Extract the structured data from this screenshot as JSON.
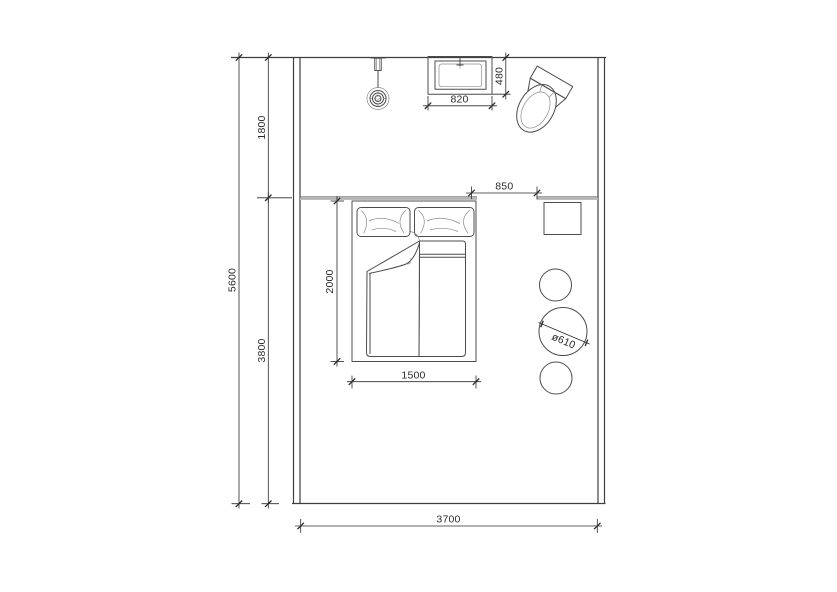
{
  "drawing": {
    "type": "bedroom floor plan",
    "dimensions_mm": {
      "total_depth": "5600",
      "entry_zone_depth": "1800",
      "bedroom_zone_depth": "3800",
      "room_width": "3700",
      "basin_width": "820",
      "basin_depth": "480",
      "opening_width": "850",
      "bed_length": "2000",
      "bed_width": "1500",
      "stool_diameter": "ø610"
    },
    "colors": {
      "background": "#ffffff",
      "wall": "#3f3f3f",
      "furniture": "#4c4c4c",
      "dimension": "#2b2b2b",
      "partition": "#b4b4b4"
    },
    "fixtures": [
      "pendant-light",
      "wash-basin",
      "toilet",
      "partition-wall",
      "double-bed",
      "pillows",
      "duvet",
      "nightstand",
      "round-stools"
    ]
  }
}
